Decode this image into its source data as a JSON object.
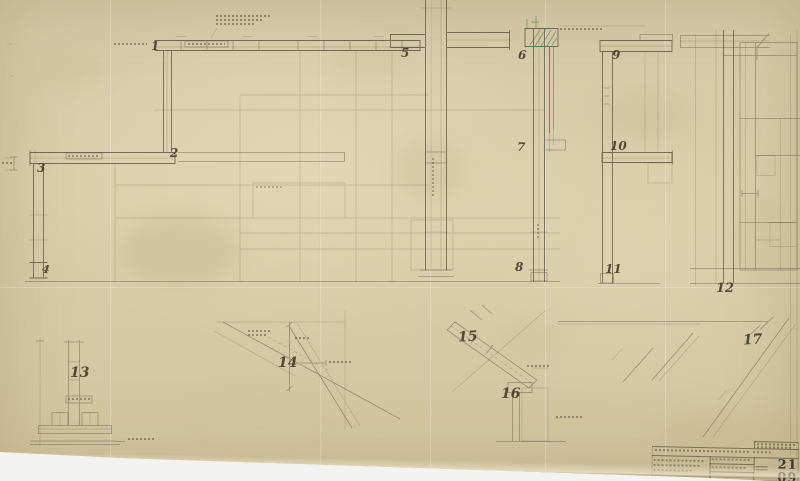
{
  "sheet": {
    "kind": "archival structural steel detail drawing",
    "number": "21 09"
  },
  "details": {
    "labels": [
      "1",
      "2",
      "3",
      "4",
      "5",
      "6",
      "7",
      "8",
      "9",
      "10",
      "11",
      "12",
      "13",
      "14",
      "15",
      "16",
      "17"
    ]
  },
  "title_block": {
    "sheet_number": "21 09"
  },
  "colors": {
    "paper": "#d8cba9",
    "background": "#f2f3f0",
    "ink": "#5c5444",
    "numeral_ink": "#443c2b",
    "annotation_green": "#4a7f54"
  }
}
